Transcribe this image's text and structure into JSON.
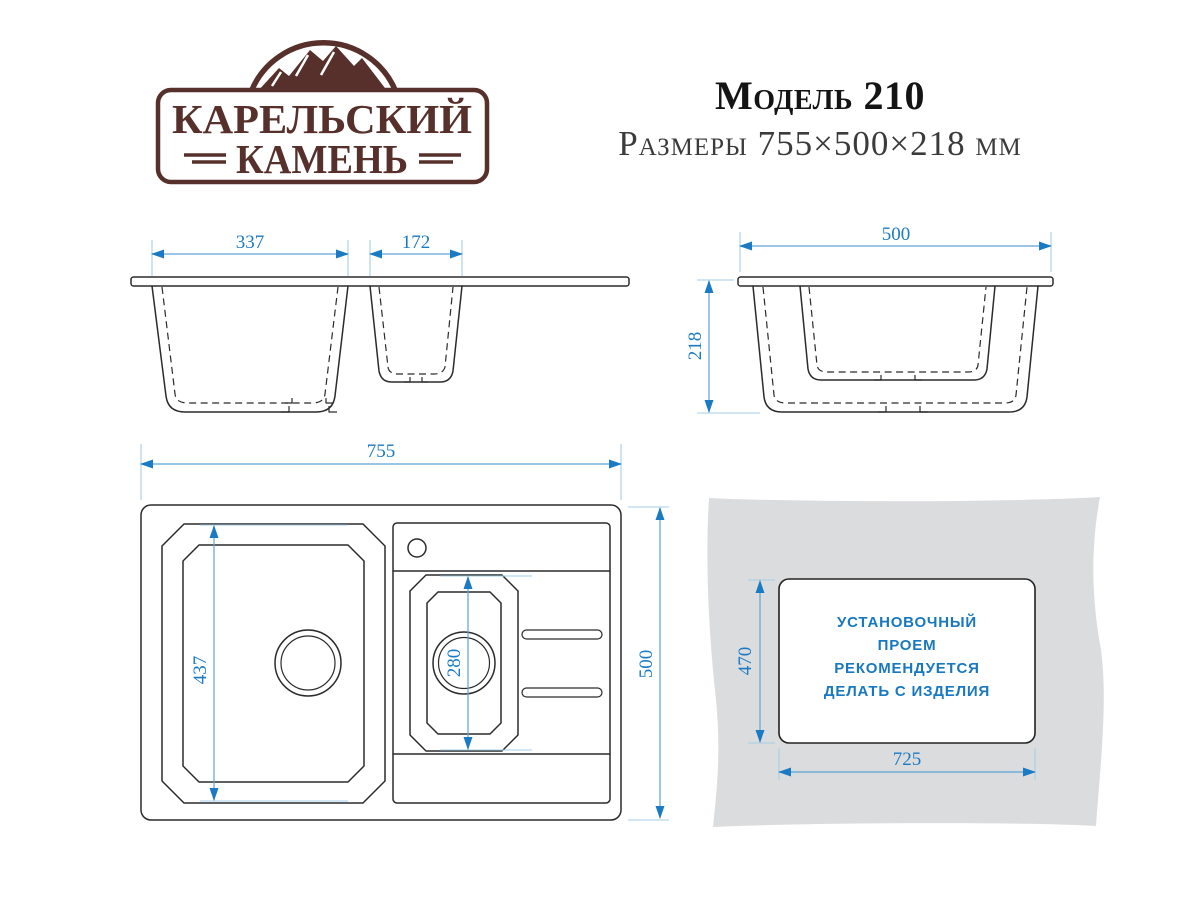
{
  "brand": {
    "line1": "КАРЕЛЬСКИЙ",
    "line2": "КАМЕНЬ"
  },
  "header": {
    "model": "Модель 210",
    "dimensions": "Размеры 755×500×218 мм"
  },
  "colors": {
    "dimension_text_blue": "#1b7ac4",
    "dimension_line_blue": "#5da3d6",
    "drawing_line": "#2b2b2b",
    "logo_brown": "#57302c",
    "countertop_gray": "#dbdcdd"
  },
  "front_view": {
    "bowl_width": "337",
    "small_bowl_width": "172"
  },
  "side_view": {
    "width": "500",
    "height": "218"
  },
  "top_view": {
    "width": "755",
    "bowl_length": "437",
    "small_bowl_length": "280",
    "depth": "500"
  },
  "install_view": {
    "cutout_height": "470",
    "cutout_width": "725",
    "note_lines": [
      "УСТАНОВОЧНЫЙ",
      "ПРОЕМ",
      "РЕКОМЕНДУЕТСЯ",
      "ДЕЛАТЬ С ИЗДЕЛИЯ"
    ]
  }
}
